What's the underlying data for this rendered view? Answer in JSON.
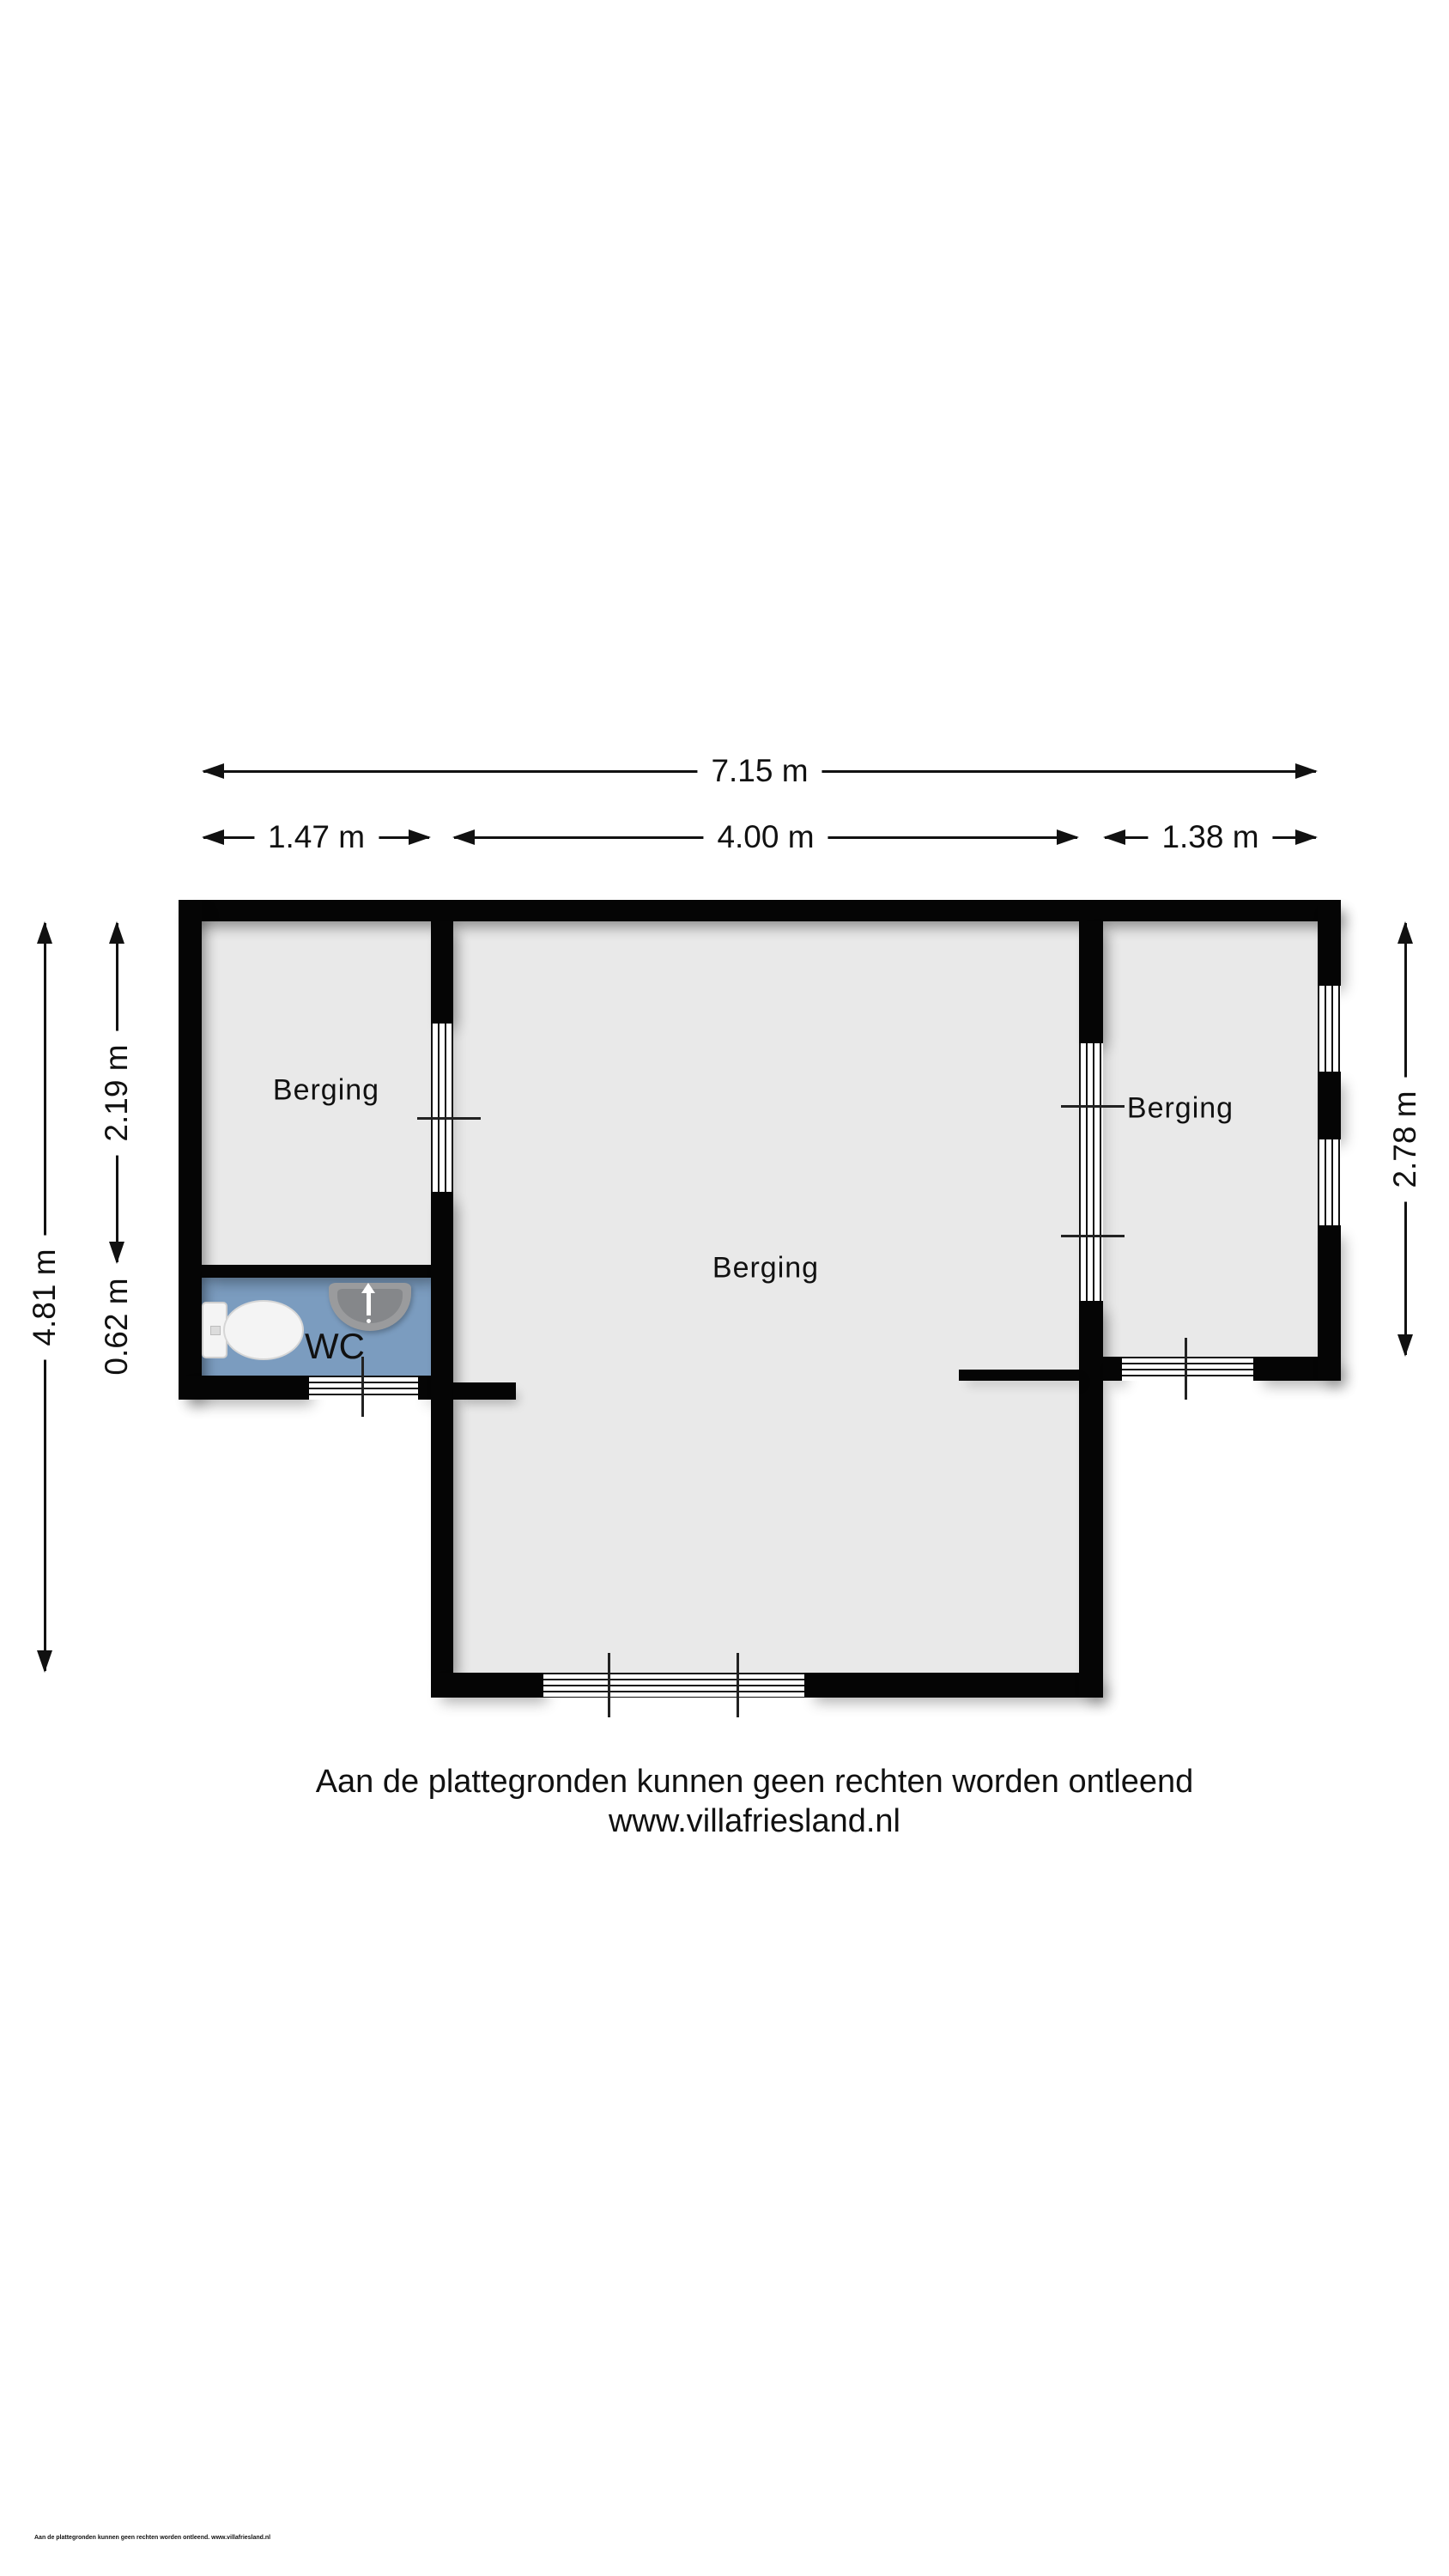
{
  "rooms": [
    {
      "id": "berging-left",
      "label": "Berging"
    },
    {
      "id": "berging-center",
      "label": "Berging"
    },
    {
      "id": "berging-right",
      "label": "Berging"
    },
    {
      "id": "wc",
      "label": "WC"
    }
  ],
  "dimensions": {
    "top_total": {
      "label": "7.15 m"
    },
    "top_left": {
      "label": "1.47 m"
    },
    "top_center": {
      "label": "4.00 m"
    },
    "top_right": {
      "label": "1.38 m"
    },
    "left_total": {
      "label": "4.81 m"
    },
    "left_upper": {
      "label": "2.19 m"
    },
    "left_wc": {
      "label": "0.62 m"
    },
    "right_side": {
      "label": "2.78 m"
    }
  },
  "footer": {
    "line1": "Aan de plattegronden kunnen geen rechten worden ontleend",
    "line2": "www.villafriesland.nl"
  },
  "fine_print": "Aan de plattegronden kunnen geen rechten worden ontleend. www.villafriesland.nl",
  "colors": {
    "wall": "#050505",
    "floor": "#e9e9e9",
    "wc_floor": "#7b9cbf",
    "fixture_gray": "#9a9b9d"
  }
}
